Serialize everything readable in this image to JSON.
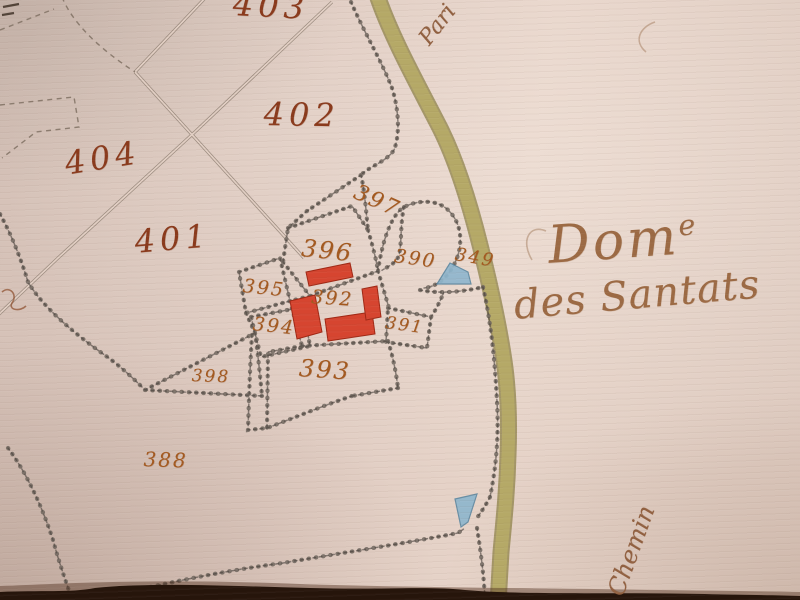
{
  "annotations": {
    "estate_word": "Dom",
    "estate_sup": "e",
    "estate_line2": "des Santats",
    "road_top": "Pari",
    "road_bottom": "Chemin"
  },
  "parcels": {
    "p349": "349",
    "p388": "388",
    "p390": "390",
    "p391": "391",
    "p392": "392",
    "p393": "393",
    "p394": "394",
    "p395": "395",
    "p396": "396",
    "p397": "397",
    "p398": "398",
    "p401": "401",
    "p402": "402",
    "p403": "403",
    "p404": "404"
  },
  "colors": {
    "paper": "#e0ccc2",
    "building_red": "#d64530",
    "road_olive": "#b7ab67",
    "water_blue": "#8fb6cd",
    "ink_big": "#8a3a1c",
    "ink_small": "#a3591f",
    "estate_ink": "#9c6a44",
    "boundary_grey": "#57504a"
  }
}
